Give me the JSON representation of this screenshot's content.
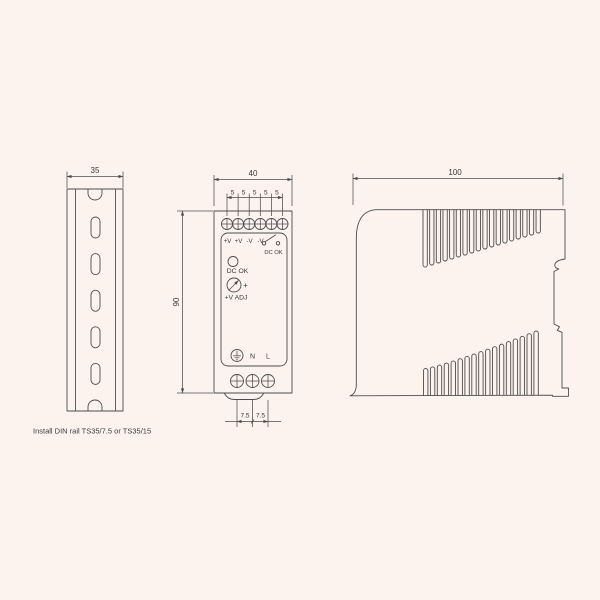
{
  "page": {
    "background": "#fcf3ee",
    "line_color": "#4d4d4d",
    "text_color": "#3a3a3a"
  },
  "din_rail_view": {
    "width_dim": "35",
    "caption": "Install DIN rail TS35/7.5 or TS35/15"
  },
  "front_view": {
    "width_dim": "40",
    "height_dim": "90",
    "terminal_pitch_dims": [
      "5",
      "5",
      "5",
      "5",
      "5"
    ],
    "output_terminal_labels": [
      "+V",
      "+V",
      "-V",
      "-V"
    ],
    "relay_contact_label": "DC OK",
    "led_label": "DC OK",
    "adjust_plus_sign": "+",
    "adjust_label": "+V ADJ",
    "input_neutral_label": "N",
    "input_line_label": "L",
    "input_pitch_dims": [
      "7.5",
      "7.5"
    ]
  },
  "side_view": {
    "width_dim": "100"
  }
}
